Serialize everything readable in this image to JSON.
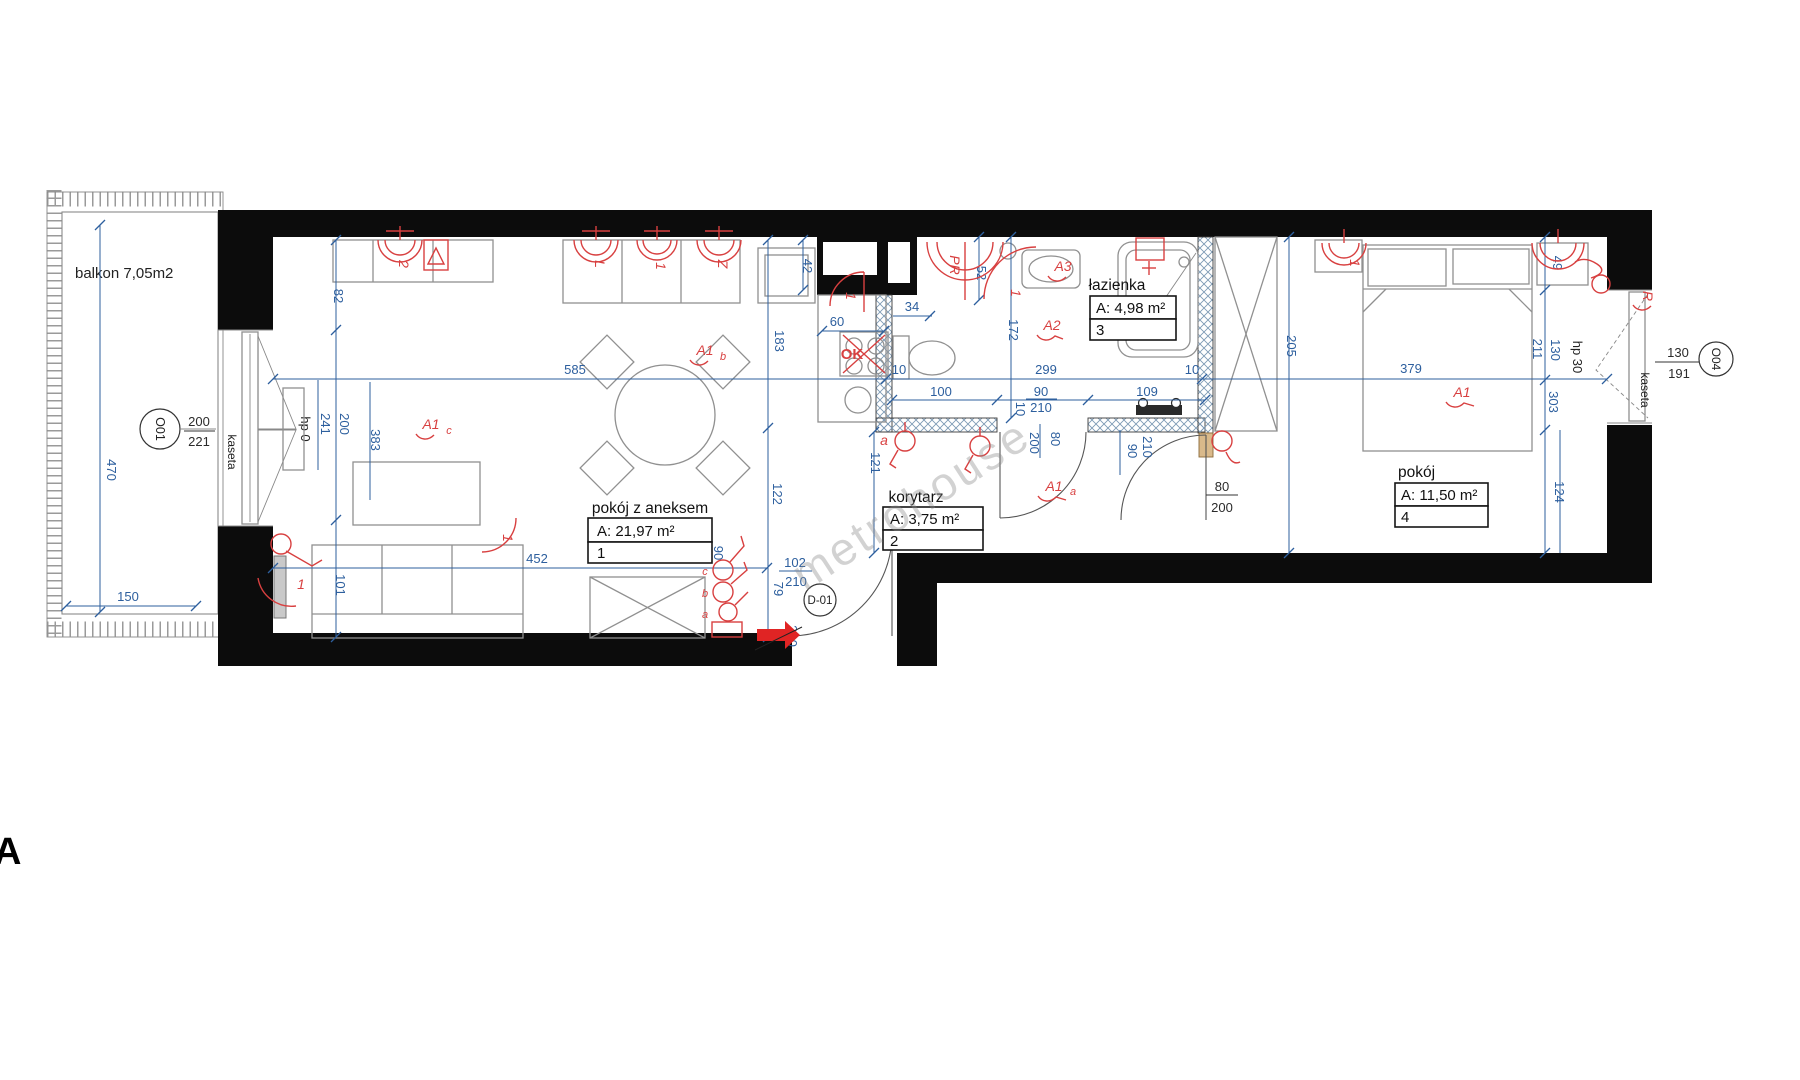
{
  "watermark": "metrohouse",
  "sheet_letter": "A",
  "balcony": {
    "label": "balkon 7,05m2"
  },
  "rooms": {
    "living": {
      "name": "pokój z aneksem",
      "area": "A: 21,97 m²",
      "number": "1"
    },
    "hall": {
      "name": "korytarz",
      "area": "A: 3,75 m²",
      "number": "2"
    },
    "bath": {
      "name": "łazienka",
      "area": "A: 4,98 m²",
      "number": "3"
    },
    "bedroom": {
      "name": "pokój",
      "area": "A: 11,50 m²",
      "number": "4"
    }
  },
  "windows": {
    "o01": {
      "id": "O01",
      "top": "200",
      "bottom": "221",
      "tag": "kaseta",
      "param": "hp 0"
    },
    "o04": {
      "id": "O04",
      "top": "130",
      "bottom": "191",
      "tag": "kaseta",
      "param": "hp 30"
    }
  },
  "door": {
    "id": "D-01"
  },
  "dims": {
    "d470": "470",
    "d150": "150",
    "d82": "82",
    "d241": "241",
    "d200_left": "200",
    "d383": "383",
    "d101": "101",
    "d452": "452",
    "d585": "585",
    "d183": "183",
    "d122": "122",
    "d42": "42",
    "d60": "60",
    "d34": "34",
    "d10_a": "10",
    "d299": "299",
    "d10_b": "10",
    "d100": "100",
    "d90_bath": "90",
    "d210_bath": "210",
    "d109": "109",
    "d10_c": "10",
    "d200_hall": "200",
    "d80_hall": "80",
    "d121": "121",
    "d172": "172",
    "d52": "52",
    "d102": "102",
    "d210_entry": "210",
    "d79": "79",
    "d200_entry": "200",
    "d90_entry": "90",
    "d90_bed": "90",
    "d210_bed": "210",
    "d80_bed": "80",
    "d200_bed": "200",
    "d205": "205",
    "d379": "379",
    "d211": "211",
    "d130_bed": "130",
    "d303": "303",
    "d124": "124",
    "d49": "49"
  },
  "red": {
    "cab_2": "2",
    "cab_L": "L",
    "cab_1": "1",
    "cab_Z": "Z",
    "kitchen_1": "1",
    "ok": "OK",
    "pr": "PR",
    "bath_1": "1",
    "a3": "A3",
    "a2": "A2",
    "a1": "A1",
    "a1a": "A1",
    "a1a_sub": "a",
    "a1b": "A1",
    "a1b_sub": "b",
    "a1c": "A1",
    "a1c_sub": "c",
    "wall_a": "a",
    "point_c": "c",
    "point_b": "b",
    "point_a": "a",
    "sofa_1": "1",
    "radiator_1": "1",
    "bed_1": "1",
    "r_mark": "R"
  }
}
